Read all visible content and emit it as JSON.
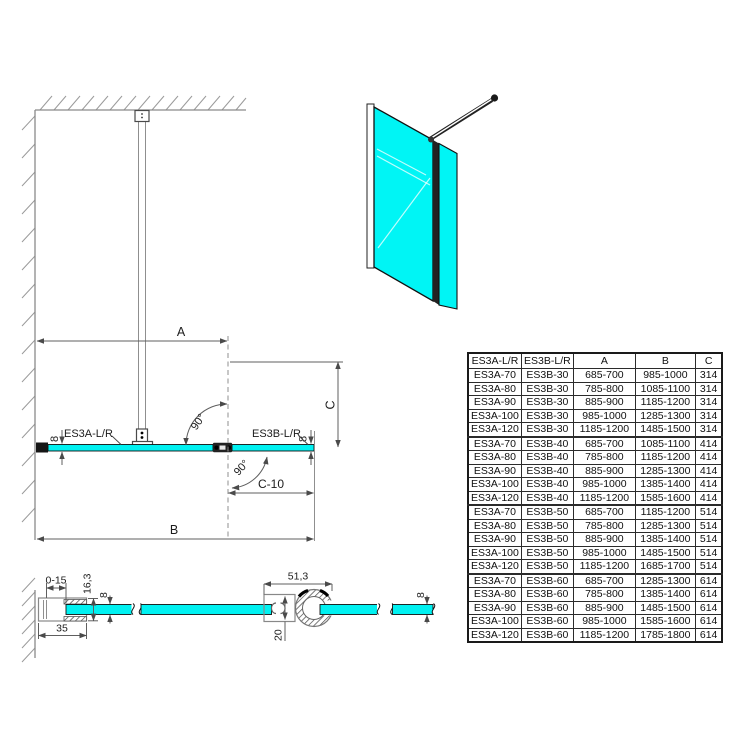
{
  "drawing": {
    "colors": {
      "glass": "#00F1F1",
      "glass_iso": "#00F5F5"
    },
    "plan": {
      "dim_a": "A",
      "dim_b": "B",
      "dim_c": "C",
      "dim_c10": "C-10",
      "angle_upper": "90°",
      "angle_lower": "90°",
      "panel_main": "ES3A-L/R",
      "panel_side": "ES3B-L/R",
      "glass_thickness_left": "8",
      "glass_thickness_right": "8"
    },
    "wall_profile_detail": {
      "adjustment_range": "0-15",
      "profile_depth": "16,3",
      "glass_thickness": "8",
      "profile_width": "35"
    },
    "connector_detail": {
      "overall_width": "51,3",
      "profile_height": "20",
      "glass_thickness": "8"
    }
  },
  "table": {
    "headers": [
      "ES3A-L/R",
      "ES3B-L/R",
      "A",
      "B",
      "C"
    ],
    "rows": [
      [
        "ES3A-70",
        "ES3B-30",
        "685-700",
        "985-1000",
        "314"
      ],
      [
        "ES3A-80",
        "ES3B-30",
        "785-800",
        "1085-1100",
        "314"
      ],
      [
        "ES3A-90",
        "ES3B-30",
        "885-900",
        "1185-1200",
        "314"
      ],
      [
        "ES3A-100",
        "ES3B-30",
        "985-1000",
        "1285-1300",
        "314"
      ],
      [
        "ES3A-120",
        "ES3B-30",
        "1185-1200",
        "1485-1500",
        "314"
      ],
      [
        "ES3A-70",
        "ES3B-40",
        "685-700",
        "1085-1100",
        "414"
      ],
      [
        "ES3A-80",
        "ES3B-40",
        "785-800",
        "1185-1200",
        "414"
      ],
      [
        "ES3A-90",
        "ES3B-40",
        "885-900",
        "1285-1300",
        "414"
      ],
      [
        "ES3A-100",
        "ES3B-40",
        "985-1000",
        "1385-1400",
        "414"
      ],
      [
        "ES3A-120",
        "ES3B-40",
        "1185-1200",
        "1585-1600",
        "414"
      ],
      [
        "ES3A-70",
        "ES3B-50",
        "685-700",
        "1185-1200",
        "514"
      ],
      [
        "ES3A-80",
        "ES3B-50",
        "785-800",
        "1285-1300",
        "514"
      ],
      [
        "ES3A-90",
        "ES3B-50",
        "885-900",
        "1385-1400",
        "514"
      ],
      [
        "ES3A-100",
        "ES3B-50",
        "985-1000",
        "1485-1500",
        "514"
      ],
      [
        "ES3A-120",
        "ES3B-50",
        "1185-1200",
        "1685-1700",
        "514"
      ],
      [
        "ES3A-70",
        "ES3B-60",
        "685-700",
        "1285-1300",
        "614"
      ],
      [
        "ES3A-80",
        "ES3B-60",
        "785-800",
        "1385-1400",
        "614"
      ],
      [
        "ES3A-90",
        "ES3B-60",
        "885-900",
        "1485-1500",
        "614"
      ],
      [
        "ES3A-100",
        "ES3B-60",
        "985-1000",
        "1585-1600",
        "614"
      ],
      [
        "ES3A-120",
        "ES3B-60",
        "1185-1200",
        "1785-1800",
        "614"
      ]
    ]
  }
}
